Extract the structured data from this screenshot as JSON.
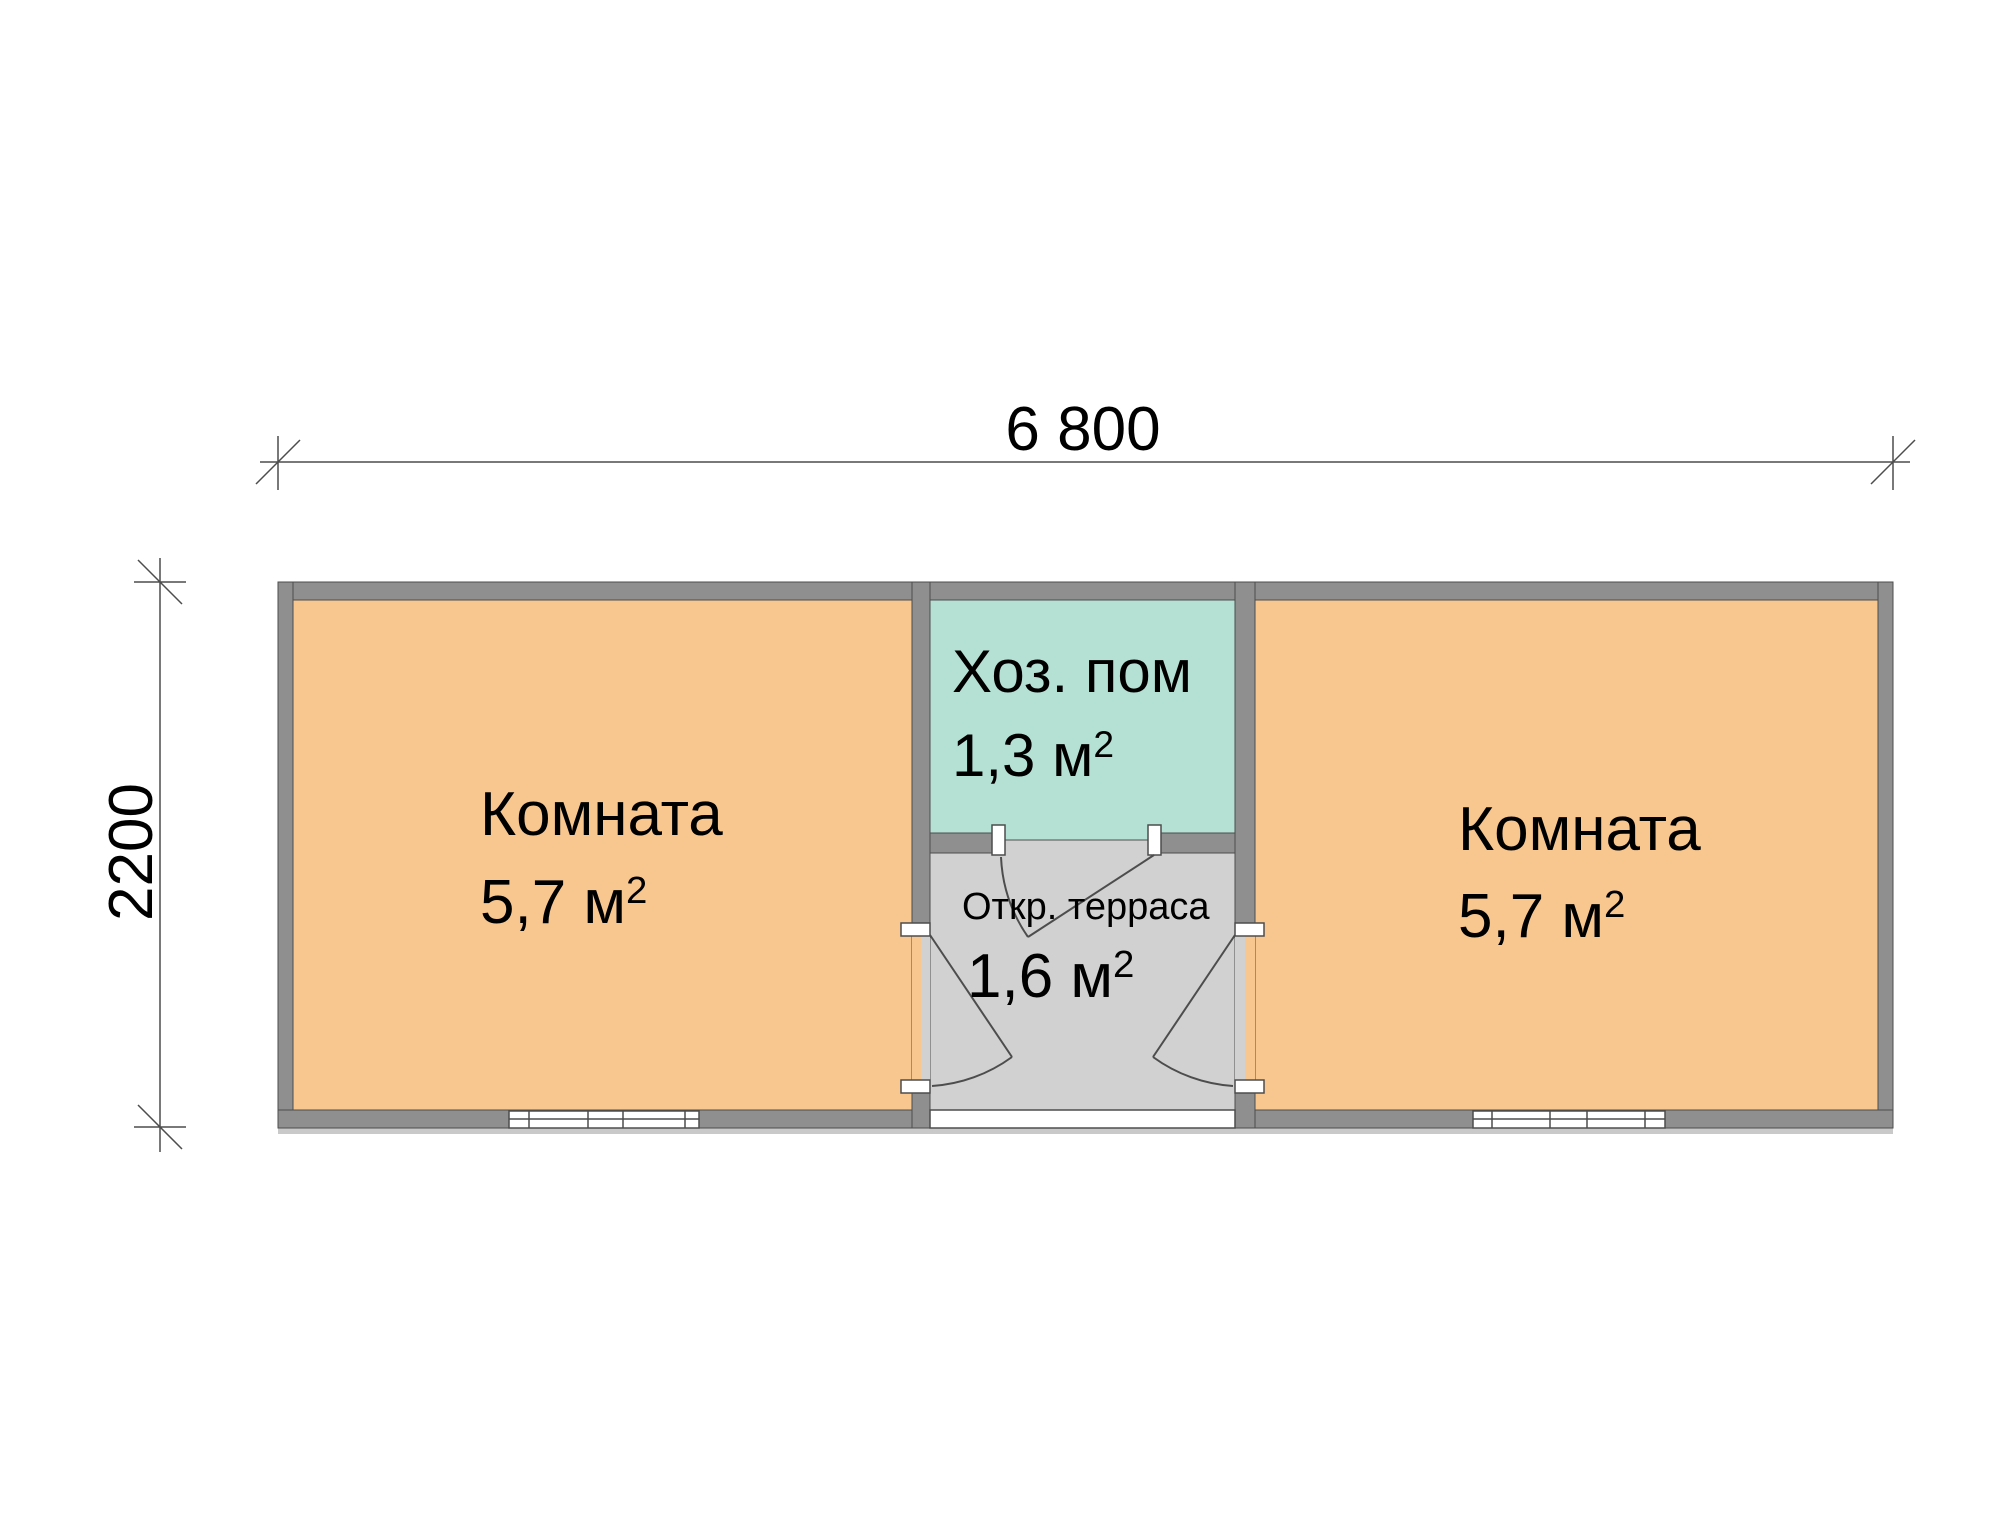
{
  "palette": {
    "room_fill": "#f8c78f",
    "utility_fill": "#b5e1d5",
    "terrace_fill": "#d1d1d1",
    "wall_fill": "#8f8f8f",
    "opening_fill": "#ffffff",
    "shadow_fill": "#c9c9c9",
    "line_color": "#4d4d4d",
    "text_color": "#000000"
  },
  "dimensions": {
    "width_label": "6 800",
    "height_label": "2200"
  },
  "rooms": {
    "left_room": {
      "name": "Комната",
      "area": "5,7 м",
      "sup": "2"
    },
    "right_room": {
      "name": "Комната",
      "area": "5,7 м",
      "sup": "2"
    },
    "utility_room": {
      "name": "Хоз. пом",
      "area": "1,3 м",
      "sup": "2"
    },
    "terrace": {
      "name": "Откр. терраса",
      "area": "1,6 м",
      "sup": "2"
    }
  }
}
